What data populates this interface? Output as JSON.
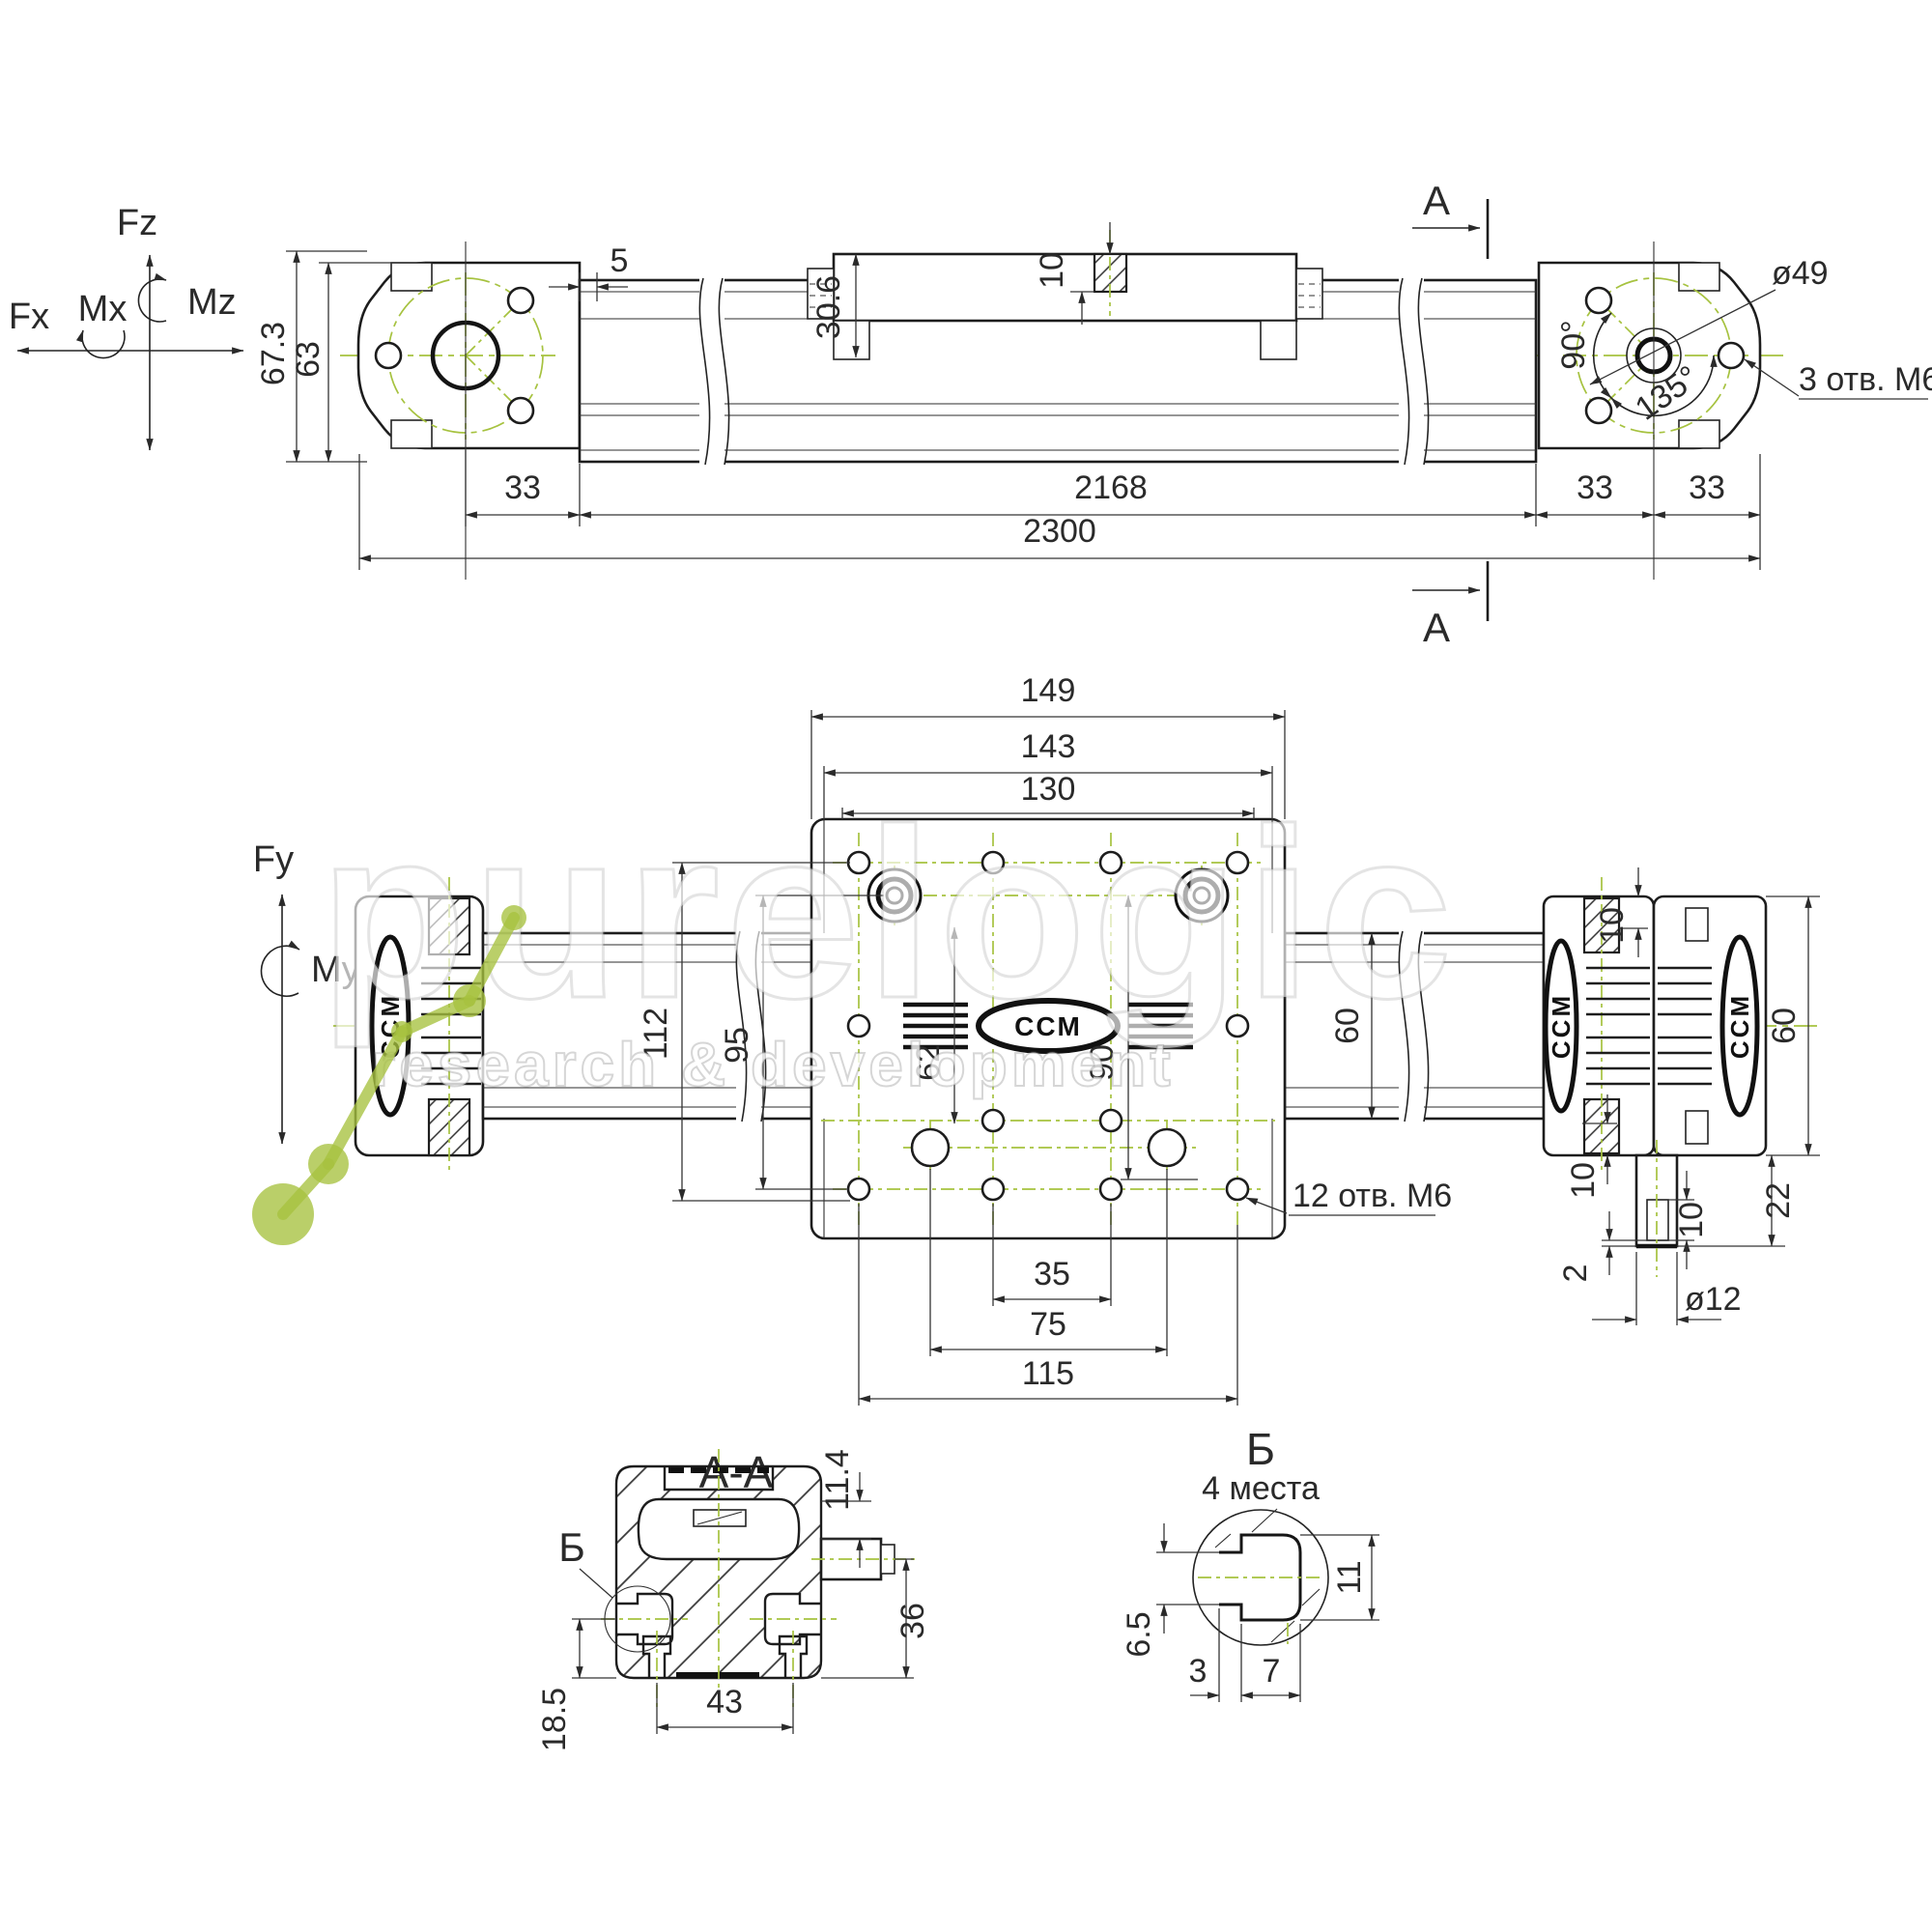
{
  "meta": {
    "drawing_type": "linear actuator dimensional drawing",
    "background": "#ffffff",
    "line_color": "#232323",
    "centerline_green": "#a6c23f",
    "watermark_opacity": "0.7"
  },
  "watermark": {
    "brand": "purelogic",
    "tagline": "research & development"
  },
  "brand": {
    "logo": "CCM"
  },
  "axes": {
    "fz": "Fz",
    "mz": "Mz",
    "mx": "Mx",
    "fx": "Fx",
    "fy": "Fy",
    "my": "My"
  },
  "top_view": {
    "h_overall": "67.3",
    "h_body": "63",
    "gap5": "5",
    "carriage_h": "30.6",
    "thread10": "10",
    "bolt_circle": "ø49",
    "a90": "90°",
    "a135": "135°",
    "note_3m6": "3 отв. М6",
    "d33a": "33",
    "d2168": "2168",
    "d33b": "33",
    "d33c": "33",
    "d2300": "2300",
    "mark": "A"
  },
  "mid_view": {
    "w149": "149",
    "w143": "143",
    "w130": "130",
    "v112": "112",
    "v95": "95",
    "v62": "62",
    "v90": "90",
    "rail60": "60",
    "blk60": "60",
    "t10": "10",
    "b10": "10",
    "s10": "10",
    "h22": "22",
    "c2": "2",
    "dia12": "ø12",
    "w35": "35",
    "w75": "75",
    "w115": "115",
    "note_12m6": "12 отв. М6"
  },
  "sec": {
    "title": "A-A",
    "d114": "11.4",
    "d36": "36",
    "d185": "18.5",
    "d43": "43",
    "callout": "Б"
  },
  "det": {
    "title": "Б",
    "sub": "4 места",
    "d65": "6.5",
    "d11": "11",
    "d3": "3",
    "d7": "7"
  }
}
